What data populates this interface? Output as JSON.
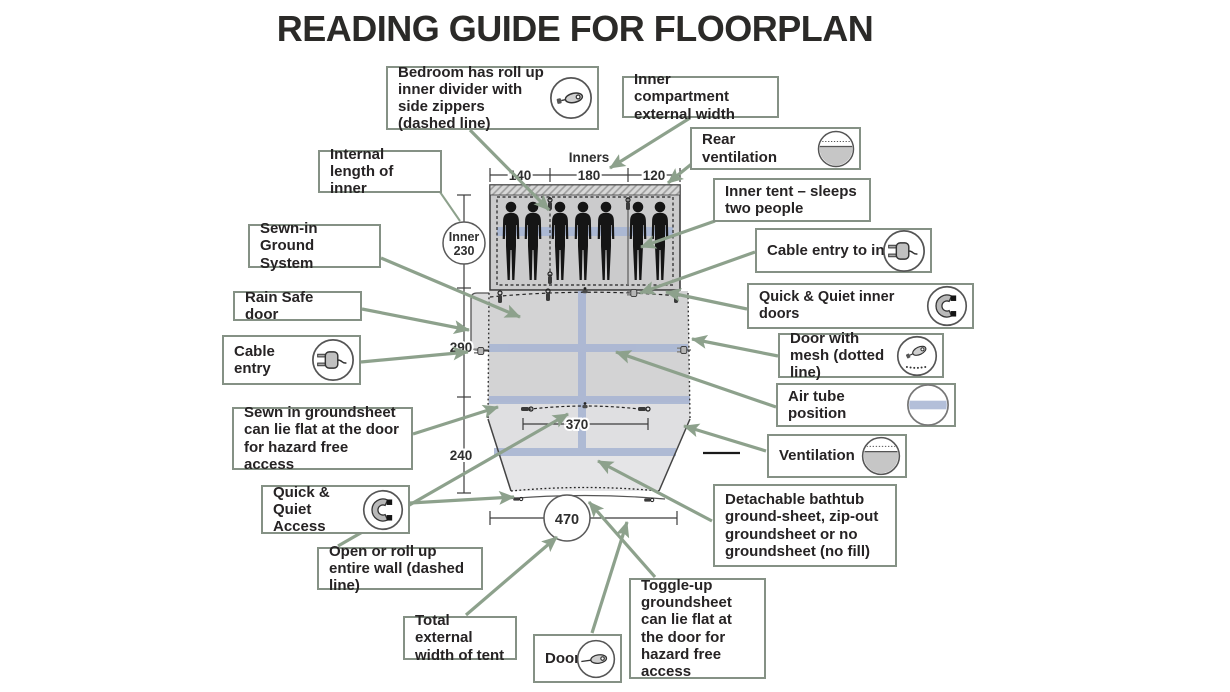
{
  "title": "READING GUIDE FOR FLOORPLAN",
  "callouts": {
    "bedroom_divider": {
      "text": "Bedroom has roll up inner divider with side zippers (dashed line)",
      "icon": "zipper-icon"
    },
    "inner_compartment_width": {
      "text": "Inner compartment external width"
    },
    "rear_ventilation": {
      "text": "Rear ventilation",
      "icon": "ventilation-icon"
    },
    "internal_length": {
      "text": "Internal length of inner"
    },
    "inner_tent": {
      "text": "Inner tent – sleeps two people"
    },
    "sewn_in_ground_system": {
      "text": "Sewn-in Ground System"
    },
    "cable_entry_inner": {
      "text": "Cable entry to inn",
      "icon": "plug-icon"
    },
    "rain_safe_door": {
      "text": "Rain Safe door"
    },
    "quick_quiet_inner_doors": {
      "text": "Quick & Quiet inner doors",
      "icon": "magnet-icon"
    },
    "cable_entry": {
      "text": "Cable entry",
      "icon": "plug-icon"
    },
    "door_with_mesh": {
      "text": "Door with mesh (dotted line)",
      "icon": "zipper-mesh-icon"
    },
    "air_tube_position": {
      "text": "Air tube position",
      "icon": "air-tube-icon"
    },
    "sewn_groundsheet": {
      "text": "Sewn in groundsheet can lie flat at the door for hazard free access"
    },
    "ventilation": {
      "text": "Ventilation",
      "icon": "ventilation-icon"
    },
    "quick_quiet_access": {
      "text": "Quick & Quiet Access",
      "icon": "magnet-icon"
    },
    "detachable_bathtub": {
      "text": "Detachable bathtub ground-sheet, zip-out groundsheet or no groundsheet (no fill)"
    },
    "open_roll_wall": {
      "text": "Open or roll up entire wall (dashed line)"
    },
    "total_external_width": {
      "text": "Total external width of tent"
    },
    "door": {
      "text": "Door",
      "icon": "zipper-icon"
    },
    "toggle_up_groundsheet": {
      "text": "Toggle-up groundsheet can lie flat at the door for hazard free access"
    }
  },
  "measurements": {
    "inners_label": "Inners",
    "inner_widths": [
      "140",
      "180",
      "120"
    ],
    "inner_length_label": "Inner",
    "inner_length_value": "230",
    "living_length": "290",
    "front_length": "240",
    "front_width": "370",
    "total_width": "470"
  },
  "colors": {
    "arrow": "#8da18c",
    "box_border": "#859185",
    "air_tube": "#a9b6d3",
    "bedroom_fill": "#cbcbcc",
    "living_fill": "#d3d3d4",
    "front_fill": "#e2e2e4"
  }
}
